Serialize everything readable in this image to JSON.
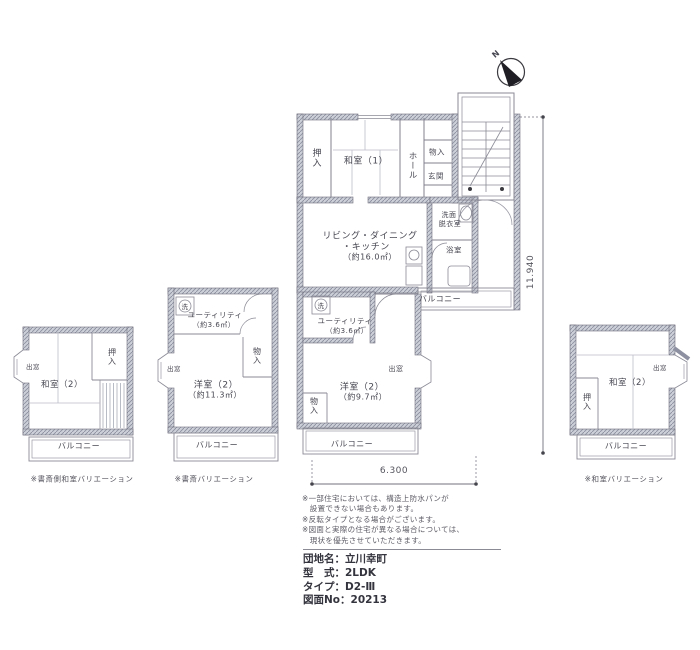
{
  "compass": {
    "n": "N"
  },
  "dimensions": {
    "height_label": "11.940",
    "width_label": "6.300"
  },
  "main_unit": {
    "oshiire": "押入",
    "washitsu": "和室（1）",
    "hall": "ホール",
    "monoire": "物入",
    "genkan": "玄関",
    "senmen1": "洗面",
    "senmen2": "脱衣室",
    "ldk1": "リビング・ダイニング",
    "ldk2": "・キッチン",
    "ldk3": "（約16.0㎡）",
    "bath": "浴室",
    "balcony": "バルコニー"
  },
  "lower_room": {
    "washer": "洗",
    "utility1": "ユーティリティ",
    "utility2": "（約3.6㎡）",
    "room": "洋室（2）",
    "area": "（約9.7㎡）",
    "monoire": "物入",
    "demado": "出窓",
    "balcony": "バルコニー"
  },
  "variation_left": {
    "demado": "出窓",
    "room": "和室（2）",
    "oshiire": "押入",
    "balcony": "バルコニー",
    "caption": "※書斎側和室バリエーション"
  },
  "variation_study": {
    "washer": "洗",
    "utility1": "ユーティリティ",
    "utility2": "（約3.6㎡）",
    "monoire": "物入",
    "demado": "出窓",
    "room": "洋室（2）",
    "area": "（約11.3㎡）",
    "balcony": "バルコニー",
    "caption": "※書斎バリエーション"
  },
  "variation_washitsu": {
    "room": "和室（2）",
    "demado": "出窓",
    "oshiire": "押入",
    "balcony": "バルコニー",
    "caption": "※和室バリエーション"
  },
  "notes": {
    "line1": "※一部住宅においては、構造上防水パンが",
    "line2": "　設置できない場合もあります。",
    "line3": "※反転タイプとなる場合がございます。",
    "line4": "※図面と実際の住宅が異なる場合については、",
    "line5": "　現状を優先させていただきます。"
  },
  "info": {
    "rows": [
      {
        "label": "団地名：",
        "value": "立川幸町"
      },
      {
        "label": "型　式：",
        "value": "2LDK"
      },
      {
        "label": "タイプ：",
        "value": "D2-Ⅲ"
      },
      {
        "label": "図面No：",
        "value": "20213"
      }
    ]
  }
}
